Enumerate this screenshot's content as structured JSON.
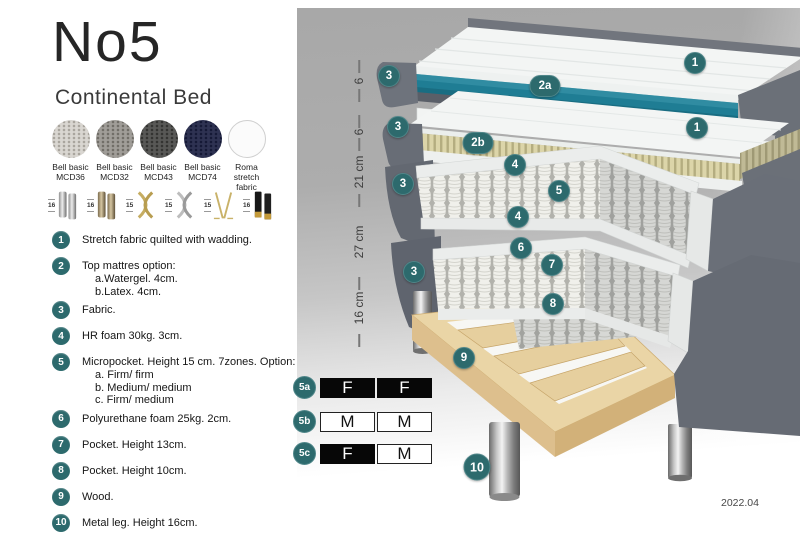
{
  "header": {
    "title": "No5",
    "subtitle": "Continental Bed"
  },
  "fabric_swatches": [
    {
      "name": "Bell basic",
      "code": "MCD36"
    },
    {
      "name": "Bell basic",
      "code": "MCD32"
    },
    {
      "name": "Bell basic",
      "code": "MCD43"
    },
    {
      "name": "Bell basic",
      "code": "MCD74"
    },
    {
      "name": "Roma",
      "code": "stretch fabric"
    }
  ],
  "leg_options": [
    {
      "height": "16",
      "finish": "chrome cylinder"
    },
    {
      "height": "16",
      "finish": "bronze cylinder"
    },
    {
      "height": "15",
      "finish": "gold cross"
    },
    {
      "height": "15",
      "finish": "chrome cross"
    },
    {
      "height": "15",
      "finish": "gold hairpin"
    },
    {
      "height": "16",
      "finish": "black with brass tip"
    }
  ],
  "spec_list": [
    {
      "num": "1",
      "text": "Stretch fabric quilted with wadding."
    },
    {
      "num": "2",
      "text": "Top mattres option:",
      "subs": [
        "a.Watergel. 4cm.",
        "b.Latex. 4cm."
      ]
    },
    {
      "num": "3",
      "text": "Fabric."
    },
    {
      "num": "4",
      "text": "HR foam 30kg. 3cm."
    },
    {
      "num": "5",
      "text": "Micropocket. Height 15 cm. 7zones. Option:",
      "subs": [
        "a. Firm/ firm",
        "b. Medium/ medium",
        "c. Firm/ medium"
      ]
    },
    {
      "num": "6",
      "text": "Polyurethane foam 25kg. 2cm."
    },
    {
      "num": "7",
      "text": "Pocket. Height 13cm."
    },
    {
      "num": "8",
      "text": "Pocket. Height 10cm."
    },
    {
      "num": "9",
      "text": "Wood."
    },
    {
      "num": "10",
      "text": "Metal leg. Height 16cm."
    }
  ],
  "diagram": {
    "dimensions": [
      "6",
      "6",
      "21 cm",
      "27 cm",
      "16 cm"
    ],
    "callouts": [
      "1",
      "3",
      "2a",
      "1",
      "3",
      "2b",
      "4",
      "3",
      "5",
      "4",
      "6",
      "3",
      "7",
      "8",
      "9",
      "10"
    ],
    "firmness_table": [
      {
        "id": "5a",
        "cells": [
          {
            "text": "F",
            "variant": "dark"
          },
          {
            "text": "F",
            "variant": "dark"
          }
        ]
      },
      {
        "id": "5b",
        "cells": [
          {
            "text": "M",
            "variant": "light"
          },
          {
            "text": "M",
            "variant": "light"
          }
        ]
      },
      {
        "id": "5c",
        "cells": [
          {
            "text": "F",
            "variant": "dark"
          },
          {
            "text": "M",
            "variant": "light"
          }
        ]
      }
    ],
    "date": "2022.04"
  },
  "colors": {
    "accent_teal": "#2d6a6d",
    "mattress_teal": "#1f7d94",
    "bed_fabric_gray": "#6b7078",
    "wood": "#ead5a6",
    "latex_tan": "#dcd5a9"
  }
}
